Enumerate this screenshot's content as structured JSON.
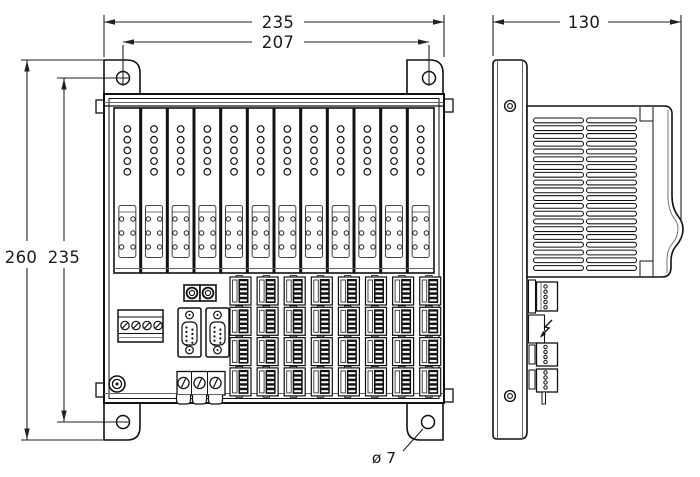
{
  "drawing_type": "technical dimension drawing, front and side view of modular I/O station",
  "labels": {
    "dim_front_width": "235",
    "dim_front_hole_span": "207",
    "dim_front_height": "260",
    "dim_front_hole_height": "235",
    "dim_side_depth": "130",
    "dim_hole_dia": "ø 7"
  },
  "front_view": {
    "module_count": 12,
    "leds_per_module": 5,
    "module_pin_rows": 3,
    "terminal_grid": {
      "rows": 4,
      "cols": 8,
      "slots_per_terminal": 5
    },
    "power_terminal_screws": 4,
    "dsub_connectors": 2,
    "dsub_pins": 9,
    "round_connectors": 2,
    "strain_relief_screws": 3,
    "mounting_holes": 4
  },
  "side_view": {
    "vent_columns": 2,
    "vent_rows": 20,
    "mounting_screws": 2,
    "side_connector_pin_counts": [
      5,
      4,
      4
    ]
  },
  "colors": {
    "line": "#111111",
    "thin_line": "#444444",
    "dim_line": "#222222",
    "background": "#ffffff"
  }
}
